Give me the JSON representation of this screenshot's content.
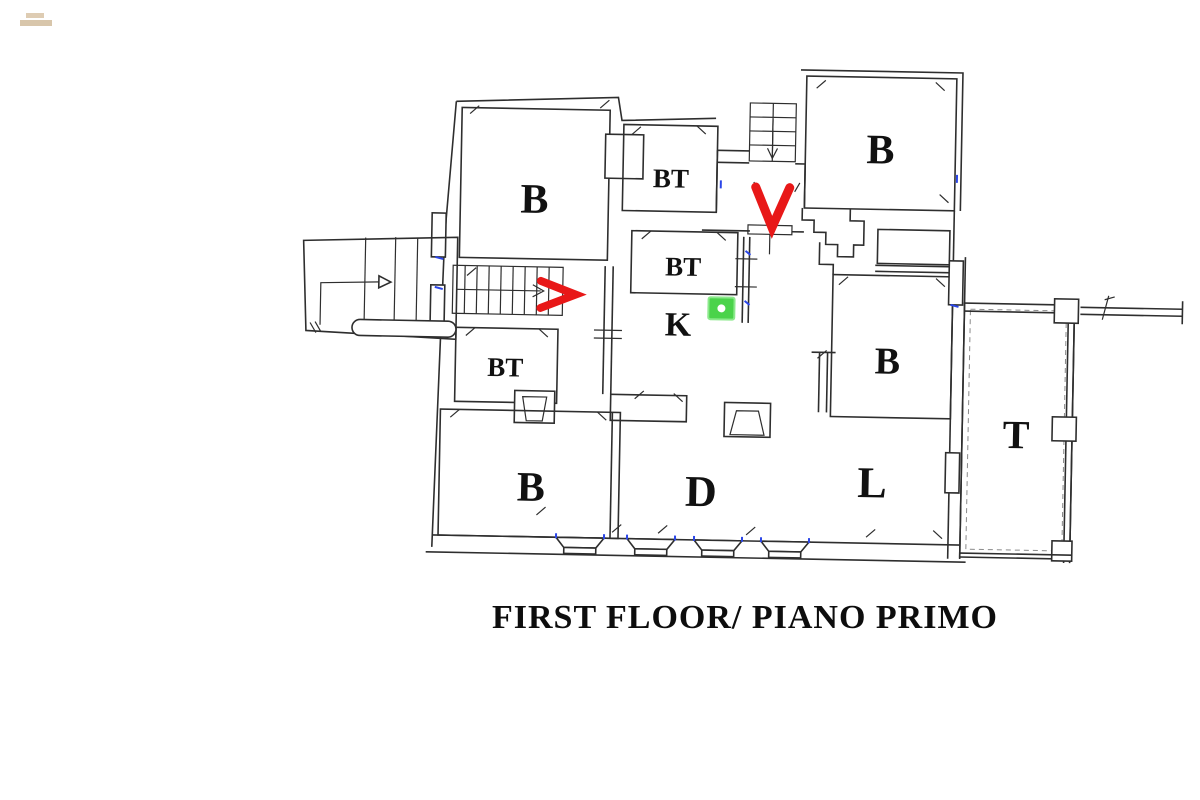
{
  "title": "FIRST FLOOR/ PIANO PRIMO",
  "plan": {
    "rooms": [
      {
        "id": "bedroom-top-left",
        "label": "B"
      },
      {
        "id": "bathroom-top",
        "label": "BT"
      },
      {
        "id": "bedroom-top-right",
        "label": "B"
      },
      {
        "id": "bathroom-middle",
        "label": "BT"
      },
      {
        "id": "kitchen",
        "label": "K"
      },
      {
        "id": "bathroom-left",
        "label": "BT"
      },
      {
        "id": "bedroom-bottom-left",
        "label": "B"
      },
      {
        "id": "dining-room",
        "label": "D"
      },
      {
        "id": "living-room",
        "label": "L"
      },
      {
        "id": "bedroom-right",
        "label": "B"
      },
      {
        "id": "terrace",
        "label": "T"
      }
    ],
    "annotations": {
      "entrance_arrow": {
        "glyph": "V",
        "color": "#e81818"
      },
      "stair_arrow": {
        "glyph": ">",
        "color": "#e81818"
      },
      "position_marker": {
        "fill": "#4ad34a",
        "border": "#8ce98c",
        "dot_color": "#ffffff"
      }
    },
    "colors": {
      "wall": "#2e2e2e",
      "window_mark": "#2b46e8",
      "paper": "#ffffff",
      "watermark": "#c9ae88"
    }
  }
}
